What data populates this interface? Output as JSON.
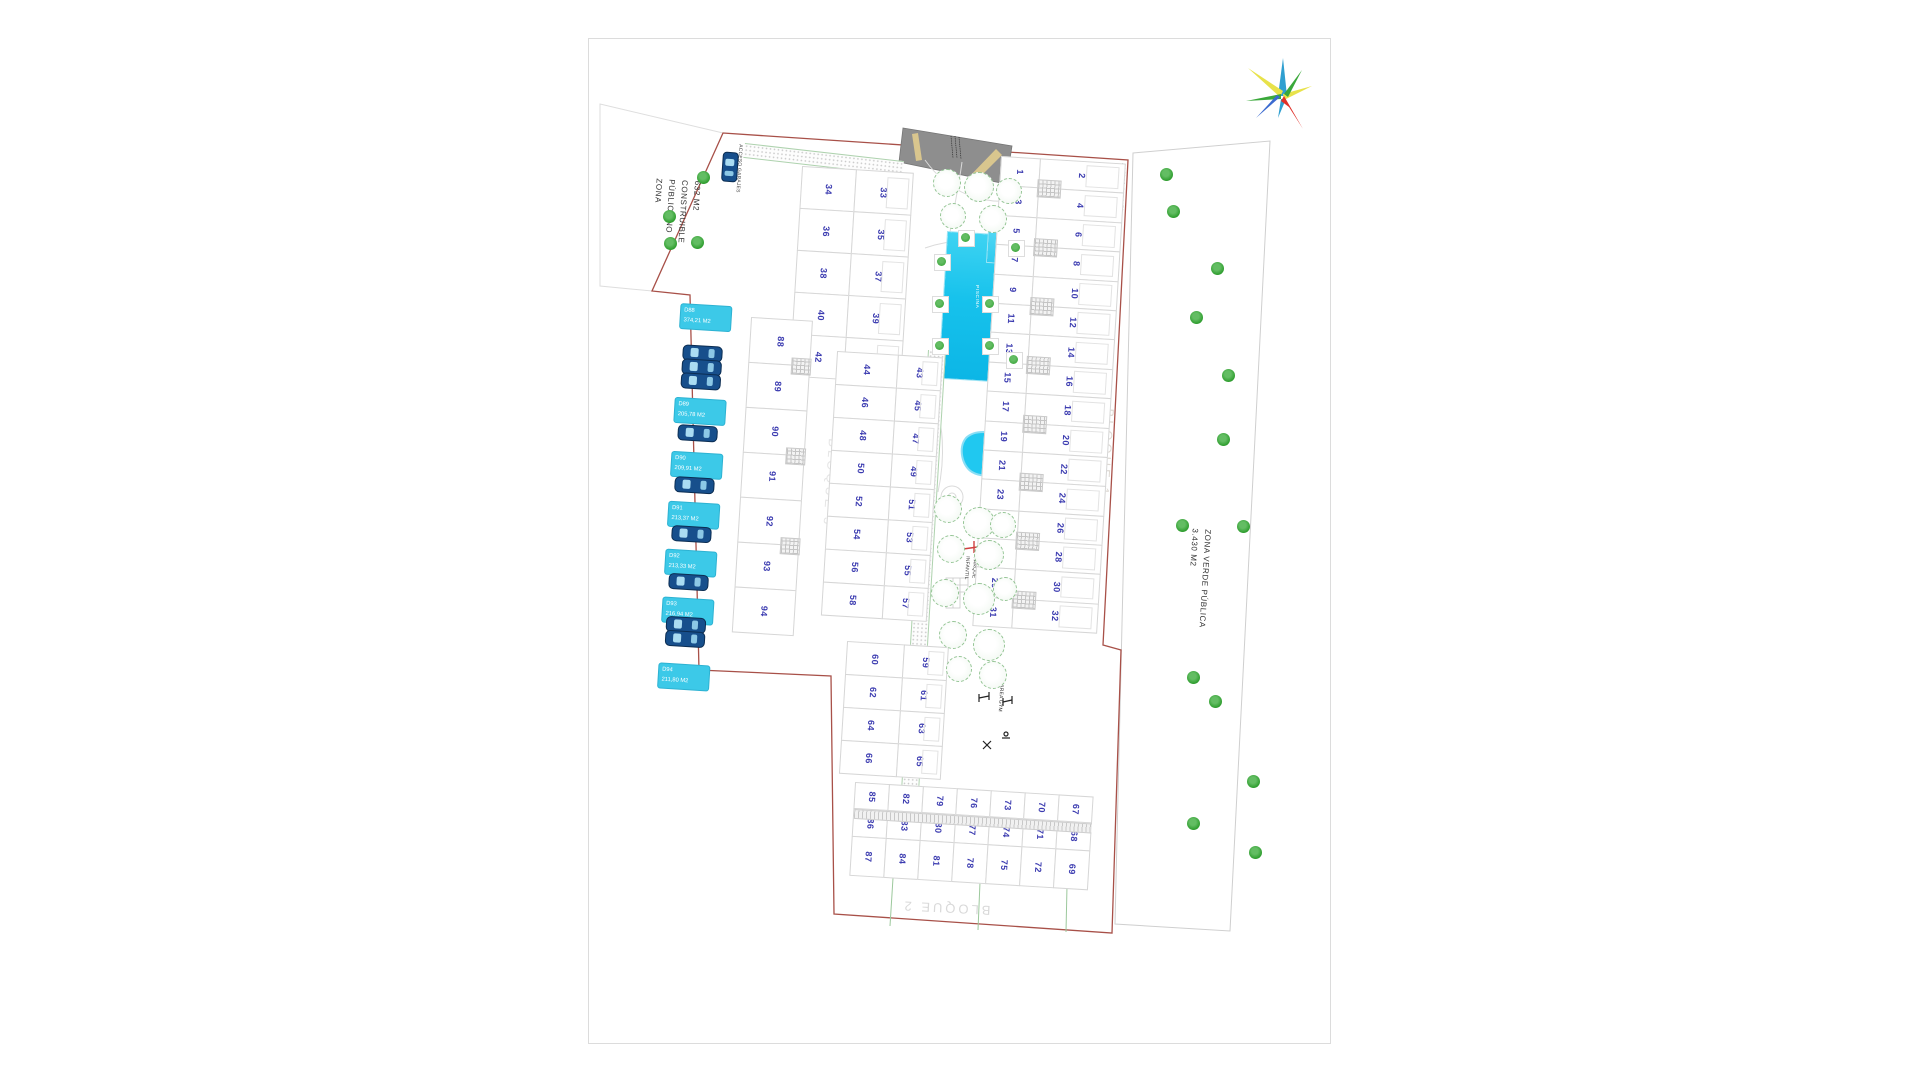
{
  "plan": {
    "labels": {
      "zona_publica": {
        "line1": "ZONA",
        "line2": "PÚBLICA NO",
        "line3": "CONSTRUIBLE",
        "line4": "632 M2"
      },
      "zona_verde": {
        "line1": "ZONA VERDE PÚBLICA",
        "line2": "3.430 M2"
      },
      "acceso_garajes_left": "ACCESO GARAJES",
      "acceso_garajes_right": "ACCESO GARAJES",
      "bloque_1": "BLOQUE 1",
      "bloque_2": "BLOQUE 2",
      "bloque_3": "BLOQUE 3",
      "parque_infantil_1": "PARQUE",
      "parque_infantil_2": "INFANTIL",
      "area_gym": "AREA GYM",
      "piscina": "PISCINA"
    },
    "plots": {
      "row_east_front": [
        1,
        3,
        5,
        7,
        9,
        11,
        13,
        15,
        17,
        19,
        21,
        23,
        25,
        27,
        29,
        31
      ],
      "row_east_back": [
        2,
        4,
        6,
        8,
        10,
        12,
        14,
        16,
        18,
        20,
        22,
        24,
        26,
        28,
        30,
        32
      ],
      "block_nw_left": [
        34,
        36,
        38,
        40,
        42
      ],
      "block_nw_right": [
        33,
        35,
        37,
        39,
        41
      ],
      "block_mid_left": [
        44,
        46,
        48,
        50,
        52,
        54,
        56,
        58
      ],
      "block_mid_right": [
        43,
        45,
        47,
        49,
        51,
        53,
        55,
        57
      ],
      "block_low_left": [
        60,
        62,
        64,
        66
      ],
      "block_low_right": [
        59,
        61,
        63,
        65
      ],
      "block_south_rows": [
        [
          85,
          82,
          79,
          76,
          73,
          70,
          67
        ],
        [
          86,
          83,
          80,
          77,
          74,
          71,
          68
        ],
        [
          87,
          84,
          81,
          78,
          75,
          72,
          69
        ]
      ],
      "col_west": [
        88,
        89,
        90,
        91,
        92,
        93,
        94
      ]
    },
    "parking": [
      {
        "id": "D88",
        "area": "374,21 M2"
      },
      {
        "id": "D89",
        "area": "205,78 M2"
      },
      {
        "id": "D90",
        "area": "209,91 M2"
      },
      {
        "id": "D91",
        "area": "213,37 M2"
      },
      {
        "id": "D92",
        "area": "213,33 M2"
      },
      {
        "id": "D93",
        "area": "216,94 M2"
      },
      {
        "id": "D94",
        "area": "211,80 M2"
      }
    ],
    "colors": {
      "boundary": "#a85048",
      "plot_number": "#3b3bb0",
      "pool": "#17c2ec",
      "pool_light": "#66def6",
      "parking_label": "#3cc9e8",
      "tree": "#2f9e2f",
      "ramp": "#8e8e8e",
      "ramp_stripe": "#d9c68e",
      "playground_red": "#d04040",
      "compass_red": "#e03028",
      "car_blue": "#174f8c"
    }
  }
}
